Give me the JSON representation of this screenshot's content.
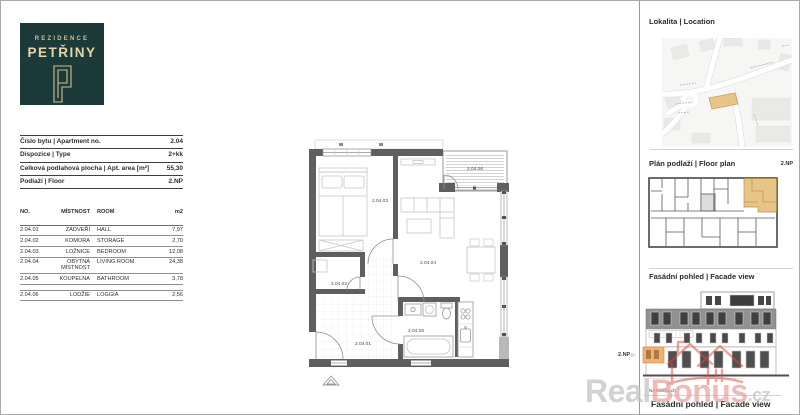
{
  "logo": {
    "brand": "REZIDENCE",
    "name": "PETŘINY",
    "bg_color": "#1d3a3a",
    "gold_color": "#e4d7ab"
  },
  "info_table": {
    "rows": [
      {
        "label": "Číslo bytu | Apartment no.",
        "value": "2.04"
      },
      {
        "label": "Dispozice | Type",
        "value": "2+kk"
      },
      {
        "label": "Celková podlahová plocha | Apt. area [m²]",
        "value": "55,30"
      },
      {
        "label": "Podlaží | Floor",
        "value": "2.NP"
      }
    ]
  },
  "room_table": {
    "headers": {
      "no": "NO.",
      "mistnost": "MÍSTNOST",
      "room": "ROOM",
      "area": "m2"
    },
    "rows": [
      {
        "no": "2.04.01",
        "mistnost": "ZÁDVEŘÍ",
        "room": "HALL",
        "area": "7,97"
      },
      {
        "no": "2.04.02",
        "mistnost": "KOMORA",
        "room": "STORAGE",
        "area": "2,70"
      },
      {
        "no": "2.04.03",
        "mistnost": "LOŽNICE",
        "room": "BEDROOM",
        "area": "12,08"
      },
      {
        "no": "2.04.04",
        "mistnost": "OBYTNÁ MÍSTNOST",
        "room": "LIVING ROOM",
        "area": "24,38"
      },
      {
        "no": "2.04.05",
        "mistnost": "KOUPELNA",
        "room": "BATHROOM",
        "area": "3,78"
      }
    ],
    "loggia_row": {
      "no": "2.04.06",
      "mistnost": "LODŽIE",
      "room": "LOGGIA",
      "area": "2,56"
    }
  },
  "floor_plan": {
    "labels": {
      "hall": "2.04.01",
      "storage": "2.04.02",
      "bedroom": "2.04.03",
      "living": "2.04.04",
      "bathroom": "2.04.05",
      "loggia": "2.04.06"
    }
  },
  "sidebar": {
    "location_title": "Lokalita | Location",
    "floorplan_title": "Plán podlaží | Floor plan",
    "floorplan_floor": "2.NP",
    "facade_title": "Fasádní pohled | Facade view",
    "facade_floor_label": "2.NP",
    "facade_floor_arrow": "▷",
    "street_label": "Na Petřinách",
    "bottom_title": "Fasádní pohled | Facade view"
  },
  "watermark": {
    "part1": "Real",
    "part2": "Bonus",
    "part3": ".cz",
    "gray_color": "#c3c3c3",
    "pink_color": "#eba49e",
    "red_color": "#d6473a"
  },
  "colors": {
    "wall": "#5f5f5f",
    "unit_highlight": "#e7c488",
    "facade_highlight": "#f0b173"
  }
}
